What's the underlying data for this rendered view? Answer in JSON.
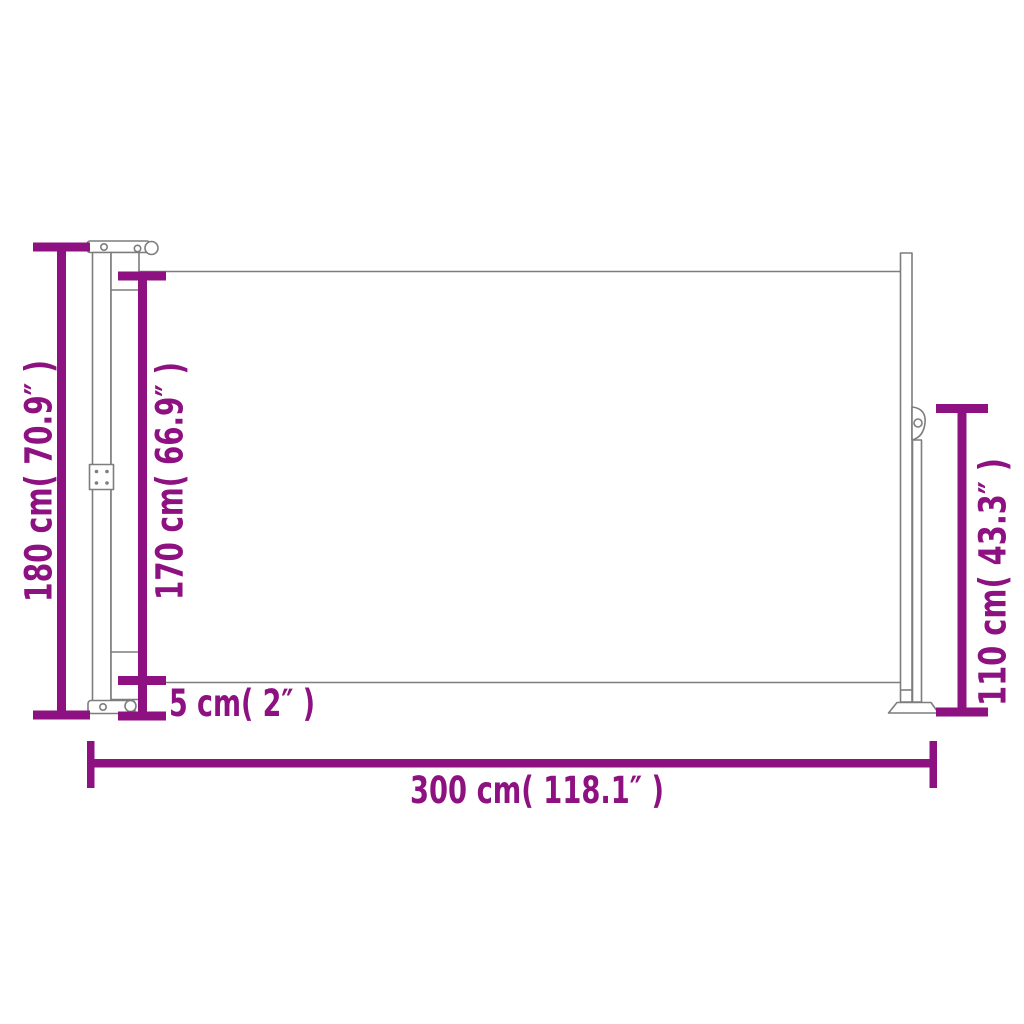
{
  "colors": {
    "dimension_accent": "#8e1181",
    "structure_outline": "#7d7d7d",
    "background": "#ffffff"
  },
  "diagram": {
    "dimensions": {
      "total_height": {
        "label": "180 cm( 70.9″ )",
        "cm": 180,
        "inch": 70.9
      },
      "fabric_height": {
        "label": "170 cm( 66.9″ )",
        "cm": 170,
        "inch": 66.9
      },
      "bottom_gap": {
        "label": "5 cm( 2″ )",
        "cm": 5,
        "inch": 2
      },
      "post_height": {
        "label": "110 cm( 43.3″ )",
        "cm": 110,
        "inch": 43.3
      },
      "total_width": {
        "label": "300 cm( 118.1″ )",
        "cm": 300,
        "inch": 118.1
      }
    }
  }
}
